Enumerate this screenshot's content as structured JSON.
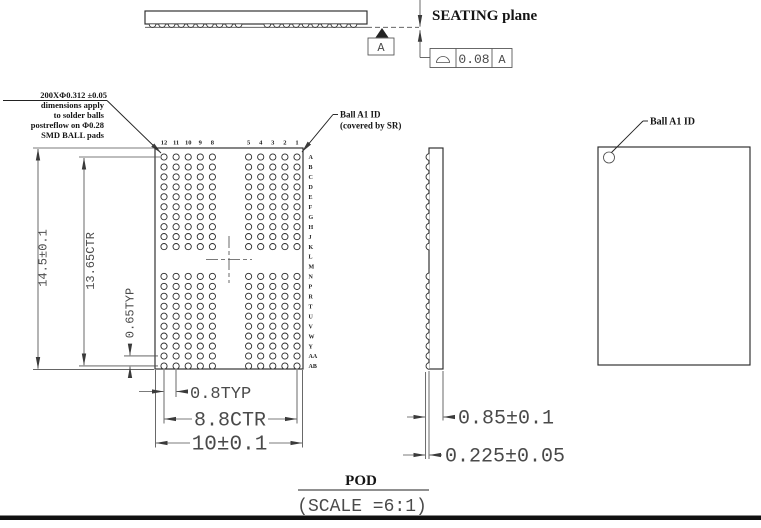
{
  "seating": {
    "label": "SEATING plane",
    "datum": "A",
    "fcf": {
      "symbol": "⌓",
      "tolerance": "0.08",
      "datum": "A"
    }
  },
  "ball_note": [
    "200XΦ0.312 ±0.05",
    "dimensions apply",
    "to solder balls",
    "postreflow on Φ0.28",
    "SMD BALL pads"
  ],
  "a1_note": [
    "Ball A1 ID",
    "(covered by SR)"
  ],
  "a1_top_label": "Ball A1 ID",
  "dims": {
    "body_length": "14.5±0.1",
    "rows_span": "13.65CTR",
    "row_pitch": "0.65TYP",
    "col_pitch": "0.8TYP",
    "cols_span": "8.8CTR",
    "body_width": "10±0.1",
    "total_height": "0.85±0.1",
    "ball_height": "0.225±0.05"
  },
  "grid": {
    "col_labels": [
      "12",
      "11",
      "10",
      "9",
      "8",
      "5",
      "4",
      "3",
      "2",
      "1"
    ],
    "col_slots": [
      0,
      1,
      2,
      3,
      4,
      7,
      8,
      9,
      10,
      11
    ],
    "row_labels": [
      "A",
      "B",
      "C",
      "D",
      "E",
      "F",
      "G",
      "H",
      "J",
      "K",
      "L",
      "M",
      "N",
      "P",
      "R",
      "T",
      "U",
      "V",
      "W",
      "Y",
      "AA",
      "AB"
    ],
    "ball_row_slots": [
      0,
      1,
      2,
      3,
      4,
      5,
      6,
      7,
      8,
      9,
      12,
      13,
      14,
      15,
      16,
      17,
      18,
      19,
      20,
      21
    ]
  },
  "title": {
    "name": "POD",
    "scale": "(SCALE =6:1)"
  }
}
